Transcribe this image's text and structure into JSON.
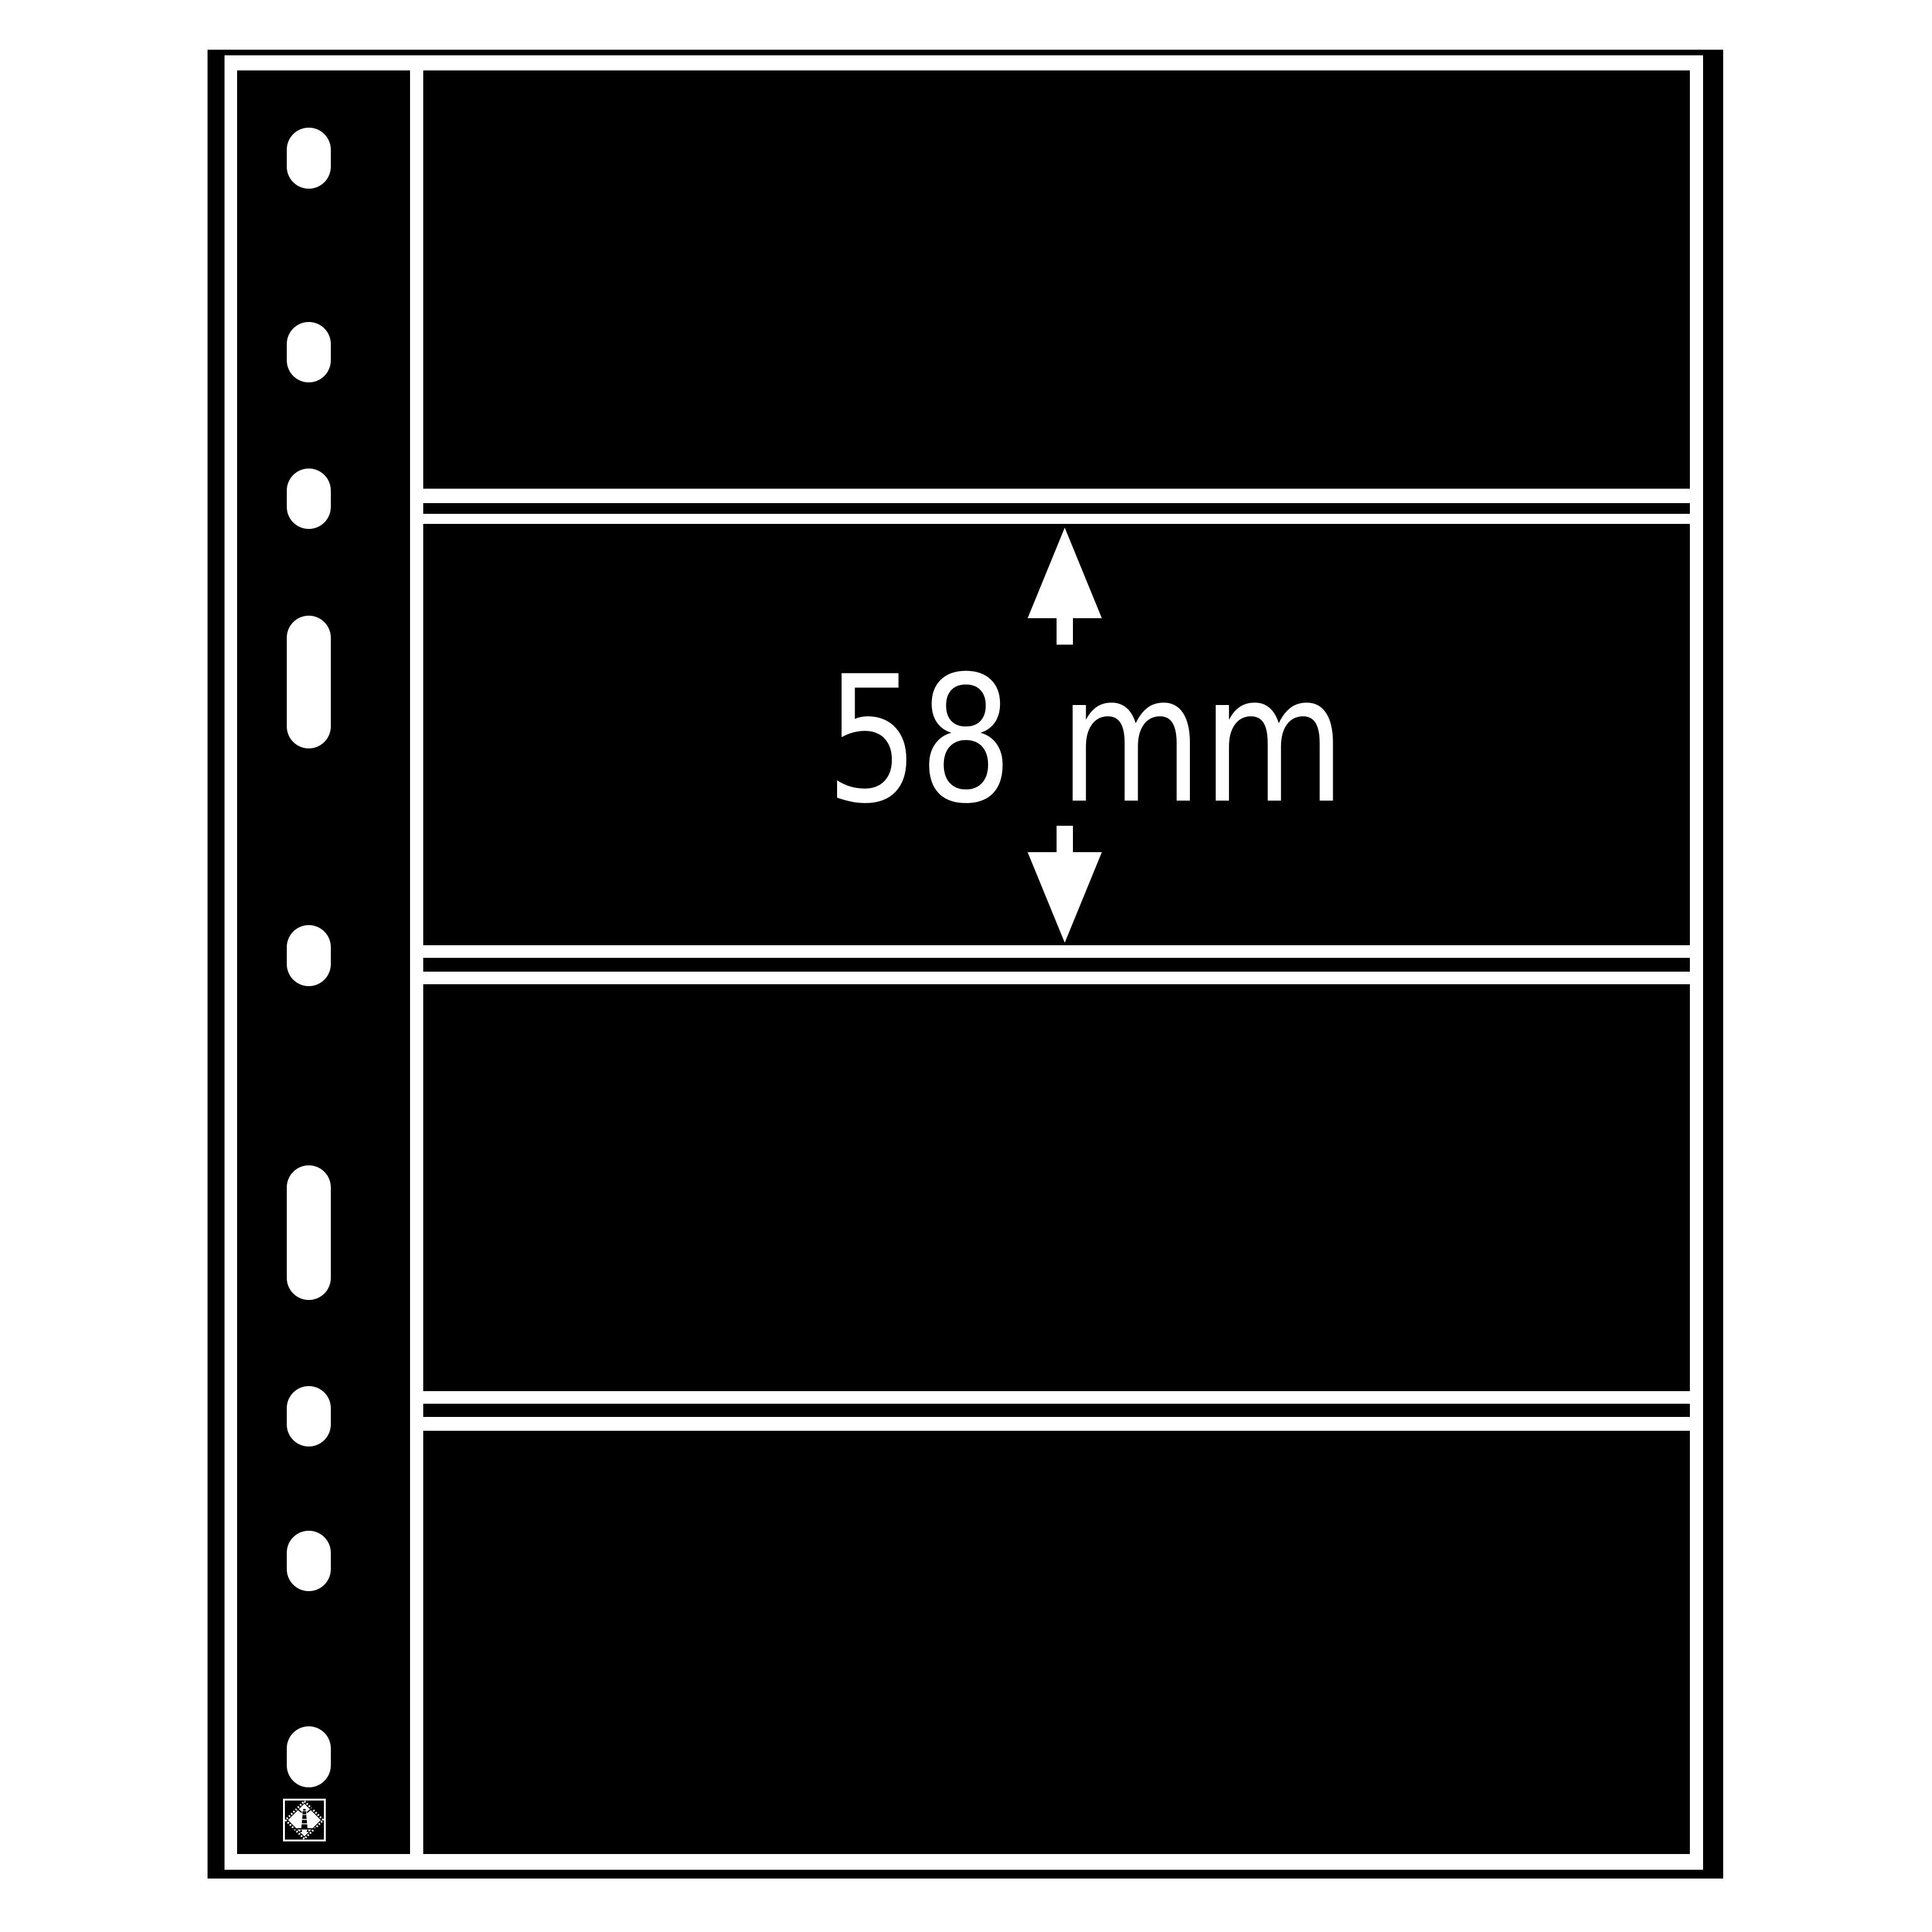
{
  "scene": {
    "background_color": "#ffffff",
    "subject": "black multi-pocket stock sheet with binder punch strip"
  },
  "sheet": {
    "color": "#000000",
    "gap_color": "#ffffff",
    "pocket_count": 4,
    "measurement": {
      "label": "58 mm",
      "value": "58",
      "unit": "mm",
      "text_color": "#ffffff",
      "applies_to": "pocket height",
      "arrow_up_icon": "arrow-up",
      "arrow_down_icon": "arrow-down"
    },
    "binder_strip": {
      "round_hole_count": 7,
      "oblong_slot_count": 2,
      "hole_color": "#ffffff"
    },
    "logo": {
      "icon": "lighthouse-stamp-diamond",
      "foreground": "#ffffff",
      "background": "#000000"
    }
  }
}
